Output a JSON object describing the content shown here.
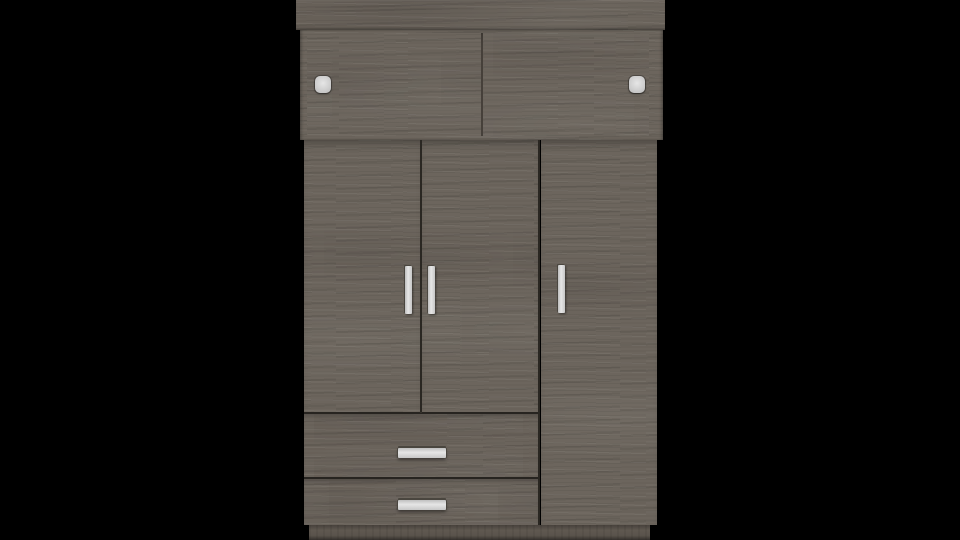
{
  "scene": {
    "type": "3d-furniture-render",
    "object": "wardrobe",
    "description": "Front view of a grey-brown wood-grain wardrobe centered on a black background: a top cabinet with two sliding doors and two small square handles, three hinged doors with vertical bar handles, two drawers with horizontal bar handles on the lower left, and a recessed plinth base.",
    "background_color": "#000000"
  },
  "colors": {
    "background": "#000000",
    "wood": "#6c655d",
    "wood-crown": "#69625a",
    "wood-recess": "#645d55",
    "wood-drawer": "#6a635b",
    "wood-plinth": "#5f5850",
    "panel-gap": "#3c3731",
    "handle-light": "#e6e6e6",
    "handle-mid": "#c7c7c7",
    "handle-edge": "#4a463f"
  },
  "wardrobe": {
    "sections": [
      {
        "name": "crown",
        "count": 1
      },
      {
        "name": "sliding-door",
        "count": 2
      },
      {
        "name": "square-handle",
        "count": 2
      },
      {
        "name": "hinged-door",
        "count": 3
      },
      {
        "name": "vertical-bar-handle",
        "count": 3
      },
      {
        "name": "drawer",
        "count": 2
      },
      {
        "name": "horizontal-bar-handle",
        "count": 2
      },
      {
        "name": "plinth",
        "count": 1
      }
    ]
  }
}
